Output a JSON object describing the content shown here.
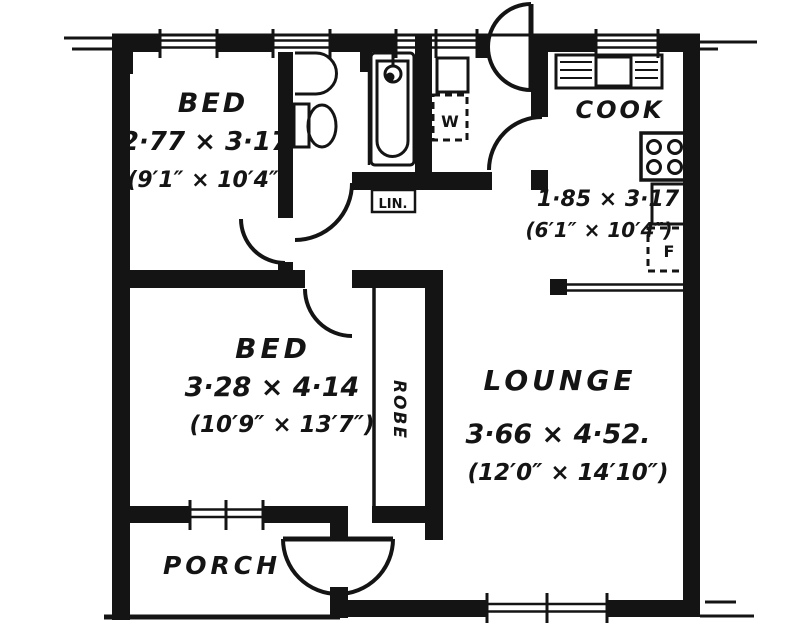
{
  "plan": {
    "title": "floor-plan",
    "rooms": {
      "bed1": {
        "name": "BED",
        "dim_metric": "2·77 × 3·17",
        "dim_imperial": "(9′1″ × 10′4″)"
      },
      "bed2": {
        "name": "BED",
        "dim_metric": "3·28 × 4·14",
        "dim_imperial": "(10′9″ × 13′7″)"
      },
      "lounge": {
        "name": "LOUNGE",
        "dim_metric": "3·66 × 4·52.",
        "dim_imperial": "(12′0″ × 14′10″)"
      },
      "cook": {
        "name": "COOK",
        "dim_metric": "1·85 × 3·17",
        "dim_imperial": "(6′1″ × 10′4″)"
      },
      "porch": {
        "name": "PORCH"
      },
      "robe": {
        "name": "ROBE"
      }
    },
    "fixtures": {
      "linen": "LIN.",
      "washer": "W",
      "fridge": "F"
    },
    "colors": {
      "ink": "#141414",
      "paper": "#ffffff"
    }
  }
}
